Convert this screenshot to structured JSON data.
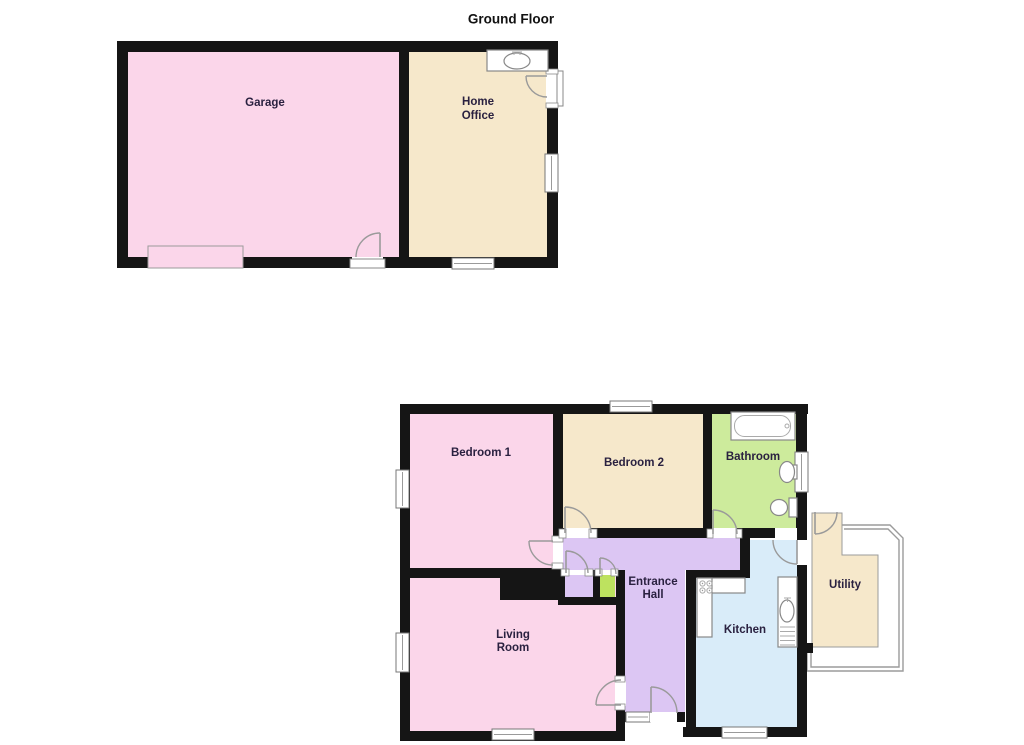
{
  "title": "Ground Floor",
  "palette": {
    "wall": "#151515",
    "pink": "#fbd6ea",
    "cream": "#f6e8cb",
    "bath_green": "#cdeb9c",
    "closet_green": "#bde25f",
    "lavender": "#dcc6f3",
    "kitchen_blue": "#d9ecf9",
    "white": "#ffffff",
    "thin_outline": "#9b9b9b",
    "label": "#2a2140"
  },
  "rooms": {
    "garage": {
      "label": "Garage"
    },
    "home_office": {
      "line1": "Home",
      "line2": "Office"
    },
    "bedroom1": {
      "label": "Bedroom 1"
    },
    "bedroom2": {
      "label": "Bedroom 2"
    },
    "bathroom": {
      "label": "Bathroom"
    },
    "entrance_hall": {
      "line1": "Entrance",
      "line2": "Hall"
    },
    "living_room": {
      "line1": "Living",
      "line2": "Room"
    },
    "kitchen": {
      "label": "Kitchen"
    },
    "utility": {
      "label": "Utility"
    }
  },
  "icons": {
    "bath": "bath-tub-icon",
    "bathroom_basin": "sink-icon",
    "toilet": "toilet-icon",
    "office_basin": "sink-icon",
    "hob": "cooker-hob-icon",
    "kitchen_sink": "kitchen-sink-drainer-icon",
    "garage_door": "garage-door",
    "doors": "door-swing-arc",
    "windows": "window"
  }
}
